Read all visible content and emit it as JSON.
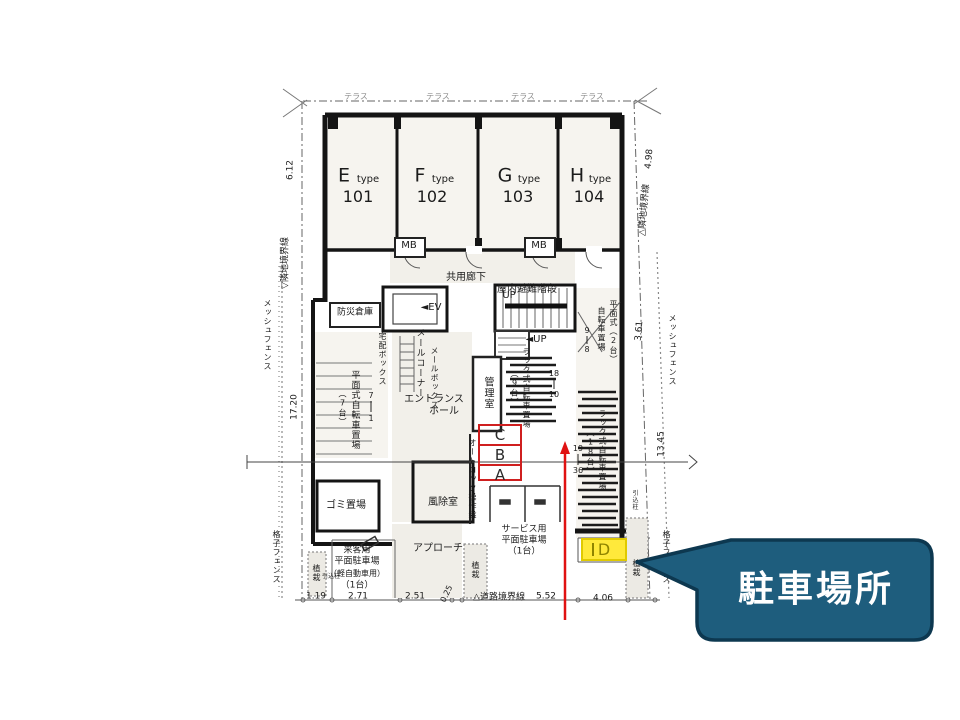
{
  "annotations": {
    "space_markers": [
      "C",
      "B",
      "A"
    ],
    "highlighted_space": "D",
    "callout_text": "駐車場所",
    "marker_color": "#cf1f1f",
    "highlight_fill": "#ffe93b",
    "callout_fill": "#1e5d7d",
    "callout_border": "#0d3850",
    "arrow_color": "#e01212"
  },
  "floor_plan": {
    "labels": [
      {
        "id": "terrace-1",
        "t": "テラス",
        "x": 356,
        "y": 97,
        "s": 8,
        "c": "#8f8f8f"
      },
      {
        "id": "terrace-2",
        "t": "テラス",
        "x": 438,
        "y": 97,
        "s": 8,
        "c": "#8f8f8f"
      },
      {
        "id": "terrace-3",
        "t": "テラス",
        "x": 523,
        "y": 97,
        "s": 8,
        "c": "#8f8f8f"
      },
      {
        "id": "terrace-4",
        "t": "テラス",
        "x": 592,
        "y": 97,
        "s": 8,
        "c": "#8f8f8f"
      },
      {
        "id": "unit-e-letter",
        "t": "E",
        "x": 344,
        "y": 176,
        "s": 19
      },
      {
        "id": "unit-e-type",
        "t": "type",
        "x": 368,
        "y": 180,
        "s": 10
      },
      {
        "id": "unit-e-number",
        "t": "101",
        "x": 358,
        "y": 197,
        "s": 16
      },
      {
        "id": "unit-f-letter",
        "t": "F",
        "x": 420,
        "y": 176,
        "s": 19
      },
      {
        "id": "unit-f-type",
        "t": "type",
        "x": 443,
        "y": 180,
        "s": 10
      },
      {
        "id": "unit-f-number",
        "t": "102",
        "x": 432,
        "y": 197,
        "s": 16
      },
      {
        "id": "unit-g-letter",
        "t": "G",
        "x": 505,
        "y": 176,
        "s": 19
      },
      {
        "id": "unit-g-type",
        "t": "type",
        "x": 529,
        "y": 180,
        "s": 10
      },
      {
        "id": "unit-g-number",
        "t": "103",
        "x": 518,
        "y": 197,
        "s": 16
      },
      {
        "id": "unit-h-letter",
        "t": "H",
        "x": 577,
        "y": 176,
        "s": 19
      },
      {
        "id": "unit-h-type",
        "t": "type",
        "x": 600,
        "y": 180,
        "s": 10
      },
      {
        "id": "unit-h-number",
        "t": "104",
        "x": 589,
        "y": 197,
        "s": 16
      },
      {
        "id": "mb-left",
        "t": "MB",
        "x": 409,
        "y": 246,
        "s": 10
      },
      {
        "id": "mb-right",
        "t": "MB",
        "x": 539,
        "y": 246,
        "s": 10
      },
      {
        "id": "common-corridor",
        "t": "共用廊下",
        "x": 466,
        "y": 278,
        "s": 10
      },
      {
        "id": "evac-stairs",
        "t": "屋内避難階段",
        "x": 527,
        "y": 290,
        "s": 10
      },
      {
        "id": "elevator",
        "t": "◄EV",
        "x": 431,
        "y": 308,
        "s": 10
      },
      {
        "id": "disaster-storage",
        "t": "防災倉庫",
        "x": 355,
        "y": 313,
        "s": 9
      },
      {
        "id": "up-1",
        "t": "UP",
        "x": 509,
        "y": 296,
        "s": 10
      },
      {
        "id": "up-2",
        "t": "◄UP",
        "x": 536,
        "y": 340,
        "s": 10
      },
      {
        "id": "mail-corner",
        "t": "メールコーナー",
        "x": 419,
        "y": 363,
        "s": 9,
        "v": 1
      },
      {
        "id": "mail-box",
        "t": "メールボックス",
        "x": 434,
        "y": 378,
        "s": 8,
        "v": 1
      },
      {
        "id": "delivery-box",
        "t": "宅配ボックス",
        "x": 382,
        "y": 359,
        "s": 8,
        "v": 1
      },
      {
        "id": "entrance-hall-1",
        "t": "エントランス",
        "x": 434,
        "y": 400,
        "s": 10
      },
      {
        "id": "entrance-hall-2",
        "t": "ホール",
        "x": 444,
        "y": 412,
        "s": 10
      },
      {
        "id": "manager-room",
        "t": "管理室",
        "x": 487,
        "y": 393,
        "s": 10,
        "v": 1
      },
      {
        "id": "windbreak-room",
        "t": "風除室",
        "x": 443,
        "y": 503,
        "s": 10
      },
      {
        "id": "autolock-panel",
        "t": "オートロック操作盤",
        "x": 472,
        "y": 479,
        "s": 8,
        "v": 1
      },
      {
        "id": "garbage-area",
        "t": "ゴミ置場",
        "x": 346,
        "y": 506,
        "s": 10
      },
      {
        "id": "visitor-parking-1",
        "t": "来客用",
        "x": 357,
        "y": 551,
        "s": 9
      },
      {
        "id": "visitor-parking-2",
        "t": "平面駐車場",
        "x": 357,
        "y": 562,
        "s": 9
      },
      {
        "id": "visitor-parking-3",
        "t": "（軽自動車用）",
        "x": 357,
        "y": 574,
        "s": 8
      },
      {
        "id": "visitor-parking-4",
        "t": "（1台）",
        "x": 357,
        "y": 586,
        "s": 9
      },
      {
        "id": "approach",
        "t": "アプローチ",
        "x": 438,
        "y": 549,
        "s": 10
      },
      {
        "id": "service-parking-1",
        "t": "サービス用",
        "x": 524,
        "y": 530,
        "s": 9
      },
      {
        "id": "service-parking-2",
        "t": "平面駐車場",
        "x": 524,
        "y": 541,
        "s": 9
      },
      {
        "id": "service-parking-3",
        "t": "（1台）",
        "x": 524,
        "y": 552,
        "s": 9
      },
      {
        "id": "flat-bike-7",
        "t": "平面式自転車置場",
        "x": 354,
        "y": 410,
        "s": 9,
        "v": 1
      },
      {
        "id": "flat-bike-7-count",
        "t": "（7台）",
        "x": 342,
        "y": 408,
        "s": 8,
        "v": 1
      },
      {
        "id": "flat-bike-7-num-top",
        "t": "7",
        "x": 371,
        "y": 396,
        "s": 8
      },
      {
        "id": "flat-bike-7-num-bottom",
        "t": "1",
        "x": 371,
        "y": 419,
        "s": 8
      },
      {
        "id": "rack-bike-9",
        "t": "ラック式自転車置場",
        "x": 526,
        "y": 388,
        "s": 8,
        "v": 1
      },
      {
        "id": "rack-bike-9-count",
        "t": "（9台）",
        "x": 514,
        "y": 388,
        "s": 8,
        "v": 1
      },
      {
        "id": "rack-9-num-top",
        "t": "18",
        "x": 554,
        "y": 374,
        "s": 8
      },
      {
        "id": "rack-9-num-bottom",
        "t": "10",
        "x": 554,
        "y": 395,
        "s": 8
      },
      {
        "id": "flat-bike-2",
        "t": "自転車置場",
        "x": 601,
        "y": 329,
        "s": 8,
        "v": 1
      },
      {
        "id": "flat-bike-2-count",
        "t": "平面式（2台）",
        "x": 613,
        "y": 332,
        "s": 8,
        "v": 1
      },
      {
        "id": "flat-2-num-top",
        "t": "9",
        "x": 587,
        "y": 331,
        "s": 8
      },
      {
        "id": "flat-2-num-bottom",
        "t": "8",
        "x": 587,
        "y": 350,
        "s": 8
      },
      {
        "id": "rack-bike-18",
        "t": "ラック式自転車置場",
        "x": 602,
        "y": 450,
        "s": 8,
        "v": 1
      },
      {
        "id": "rack-bike-18-count",
        "t": "（18台）",
        "x": 590,
        "y": 452,
        "s": 8,
        "v": 1
      },
      {
        "id": "rack-18-num-top",
        "t": "19",
        "x": 578,
        "y": 449,
        "s": 8
      },
      {
        "id": "rack-18-num-bottom",
        "t": "36",
        "x": 578,
        "y": 471,
        "s": 8
      },
      {
        "id": "dim-1-19",
        "t": "1.19",
        "x": 316,
        "y": 597,
        "s": 9
      },
      {
        "id": "dim-2-71",
        "t": "2.71",
        "x": 358,
        "y": 597,
        "s": 9
      },
      {
        "id": "dim-2-51",
        "t": "2.51",
        "x": 415,
        "y": 597,
        "s": 9
      },
      {
        "id": "dim-0-25",
        "t": "0.25",
        "x": 447,
        "y": 594,
        "s": 8,
        "r": -65
      },
      {
        "id": "road-boundary",
        "t": "△道路境界線",
        "x": 499,
        "y": 598,
        "s": 9
      },
      {
        "id": "dim-5-52",
        "t": "5.52",
        "x": 546,
        "y": 597,
        "s": 9
      },
      {
        "id": "dim-4-06",
        "t": "4.06",
        "x": 603,
        "y": 599,
        "s": 9
      },
      {
        "id": "dim-6-12",
        "t": "6.12",
        "x": 291,
        "y": 170,
        "s": 9,
        "r": -90
      },
      {
        "id": "boundary-left",
        "t": "▽隣地境界線",
        "x": 286,
        "y": 263,
        "s": 9,
        "r": -90
      },
      {
        "id": "mesh-fence-left",
        "t": "メッシュフェンス",
        "x": 267,
        "y": 335,
        "s": 8,
        "v": 1
      },
      {
        "id": "dim-17-20",
        "t": "17.20",
        "x": 295,
        "y": 407,
        "s": 9,
        "r": -90
      },
      {
        "id": "lattice-fence-left",
        "t": "格子フェンス",
        "x": 276,
        "y": 557,
        "s": 8,
        "v": 1
      },
      {
        "id": "dim-4-98",
        "t": "4.98",
        "x": 650,
        "y": 159,
        "s": 9,
        "r": -85
      },
      {
        "id": "boundary-right",
        "t": "△隣地境界線",
        "x": 645,
        "y": 210,
        "s": 9,
        "r": -85
      },
      {
        "id": "dim-3-61",
        "t": "3.61",
        "x": 640,
        "y": 331,
        "s": 9,
        "r": -85
      },
      {
        "id": "mesh-fence-right",
        "t": "メッシュフェンス",
        "x": 672,
        "y": 350,
        "s": 8,
        "v": 1
      },
      {
        "id": "dim-13-45",
        "t": "13.45",
        "x": 662,
        "y": 444,
        "s": 9,
        "r": -90
      },
      {
        "id": "lattice-fence-right",
        "t": "格子フェンス",
        "x": 666,
        "y": 557,
        "s": 8,
        "v": 1
      },
      {
        "id": "planting-left",
        "t": "植栽",
        "x": 316,
        "y": 573,
        "s": 8,
        "v": 1
      },
      {
        "id": "planting-mid",
        "t": "植栽",
        "x": 475,
        "y": 570,
        "s": 8,
        "v": 1
      },
      {
        "id": "planting-right",
        "t": "植栽",
        "x": 636,
        "y": 568,
        "s": 8,
        "v": 1
      },
      {
        "id": "utility-pole-left",
        "t": "引込柱",
        "x": 331,
        "y": 577,
        "s": 6
      },
      {
        "id": "utility-pole-right",
        "t": "引込柱",
        "x": 634,
        "y": 500,
        "s": 6,
        "v": 1
      }
    ]
  }
}
